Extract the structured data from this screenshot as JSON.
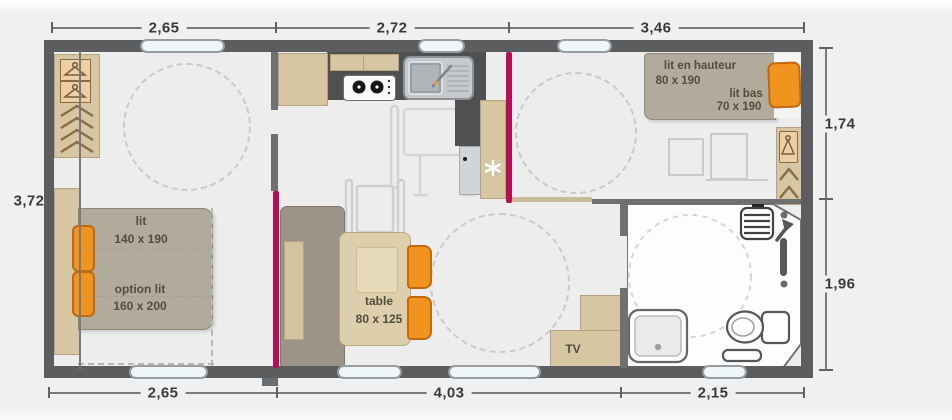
{
  "plan_title": "mobile home floor plan",
  "dims": {
    "top": [
      "2,65",
      "2,72",
      "3,46"
    ],
    "bottom": [
      "2,65",
      "4,03",
      "2,15"
    ],
    "left": "3,72",
    "right": [
      "1,74",
      "1,96"
    ]
  },
  "labels": {
    "master_bed": "lit",
    "master_bed_size": "140 x 190",
    "master_option": "option lit",
    "master_option_size": "160 x 200",
    "bunk_top": "lit en hauteur",
    "bunk_top_size": "80 x 190",
    "bunk_bottom": "lit bas",
    "bunk_bottom_size": "70 x 190",
    "table": "table",
    "table_size": "80 x 125",
    "tv": "TV"
  },
  "icons": {
    "wardrobe_hanger": "hanger-icon",
    "shelf_chevrons": "chevron-shelf-icon",
    "stove": "stove-burners-icon",
    "sink": "kitchen-sink-icon",
    "fridge": "fridge-icon",
    "snowflake": "snowflake-icon",
    "wheelchair": "wheelchair-icon",
    "shower": "shower-icon",
    "toilet": "toilet-icon",
    "radiator": "radiator-icon",
    "grab_bar": "grab-bar-icon"
  },
  "colors": {
    "wall": "#5c5d5f",
    "floor": "#ededee",
    "background": "#eff0f2",
    "furniture_tan": "#d6c6a2",
    "bed_gray": "#b2ab9b",
    "accent_orange": "#f1931f",
    "sliding_door_magenta": "#b30e56",
    "counter_dark": "#4e5052",
    "window_fill": "#eef6fa",
    "bathroom_floor": "#fdfdfd"
  }
}
